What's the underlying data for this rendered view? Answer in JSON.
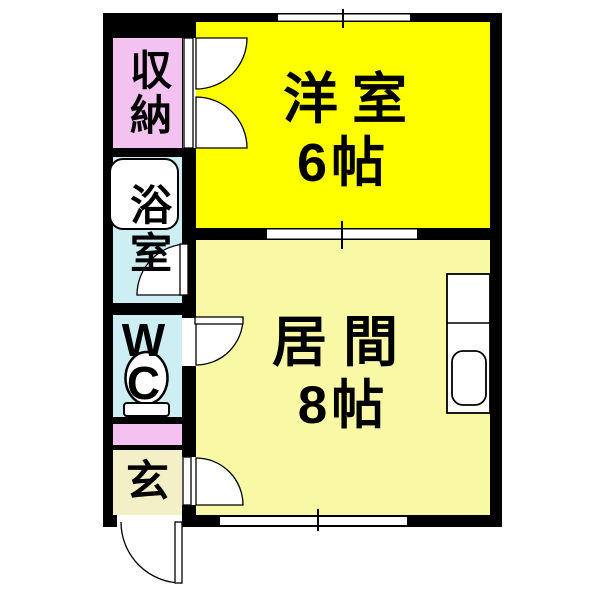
{
  "plan": {
    "type": "floor-plan",
    "rooms": {
      "storage": {
        "label": "収納"
      },
      "bathroom": {
        "label": "浴室"
      },
      "wc": {
        "label": "W\nC"
      },
      "entrance": {
        "label": "玄"
      },
      "western_room": {
        "name": "洋室",
        "size": "6帖"
      },
      "living_room": {
        "name": "居間",
        "size": "8帖"
      }
    },
    "fixtures": [
      "bathtub",
      "toilet",
      "kitchen-sink",
      "entrance-door",
      "closet-double-doors",
      "windows"
    ]
  },
  "colors": {
    "wall": "#000000",
    "storage_pink": "#f4c2f0",
    "bath_cyan": "#cdeff3",
    "hall_pink": "#f4c2f0",
    "entrance_cream": "#f3efc6",
    "western_yellow": "#ffff00",
    "living_yellow": "#f9f9a5",
    "fixture_white": "#ffffff"
  }
}
